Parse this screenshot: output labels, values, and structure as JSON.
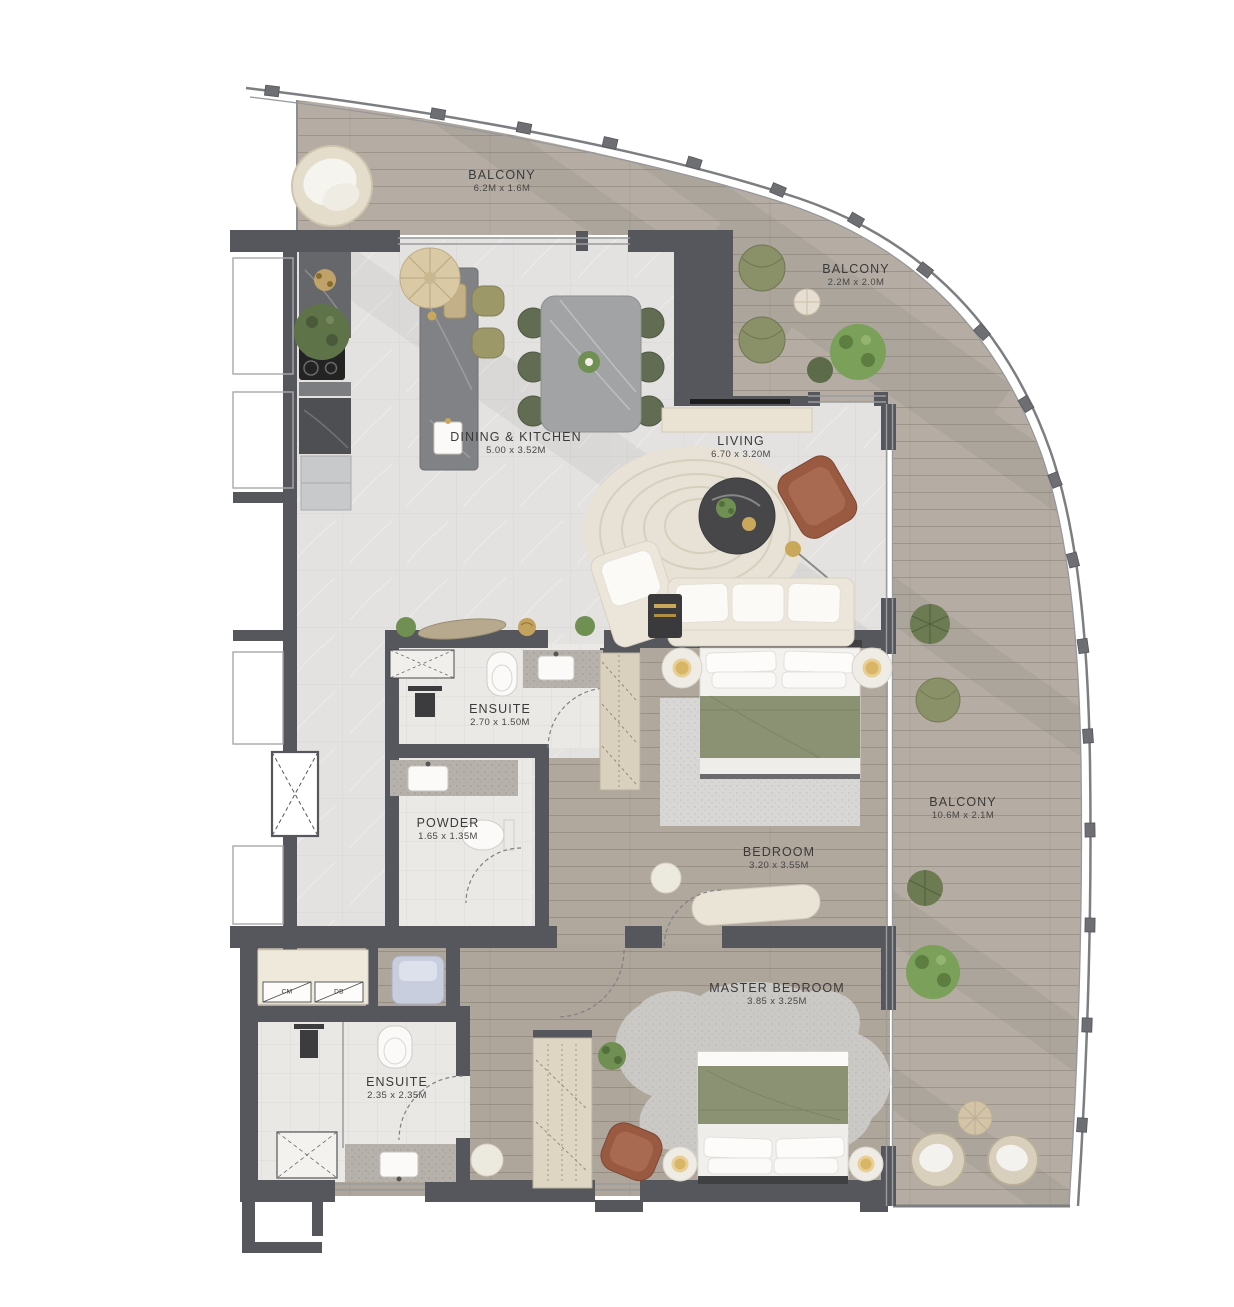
{
  "plan": {
    "rooms": [
      {
        "id": "balcony-top",
        "name": "BALCONY",
        "dims": "6.2M x 1.6M"
      },
      {
        "id": "balcony-upper-right",
        "name": "BALCONY",
        "dims": "2.2M x 2.0M"
      },
      {
        "id": "dining-kitchen",
        "name": "DINING & KITCHEN",
        "dims": "5.00 x 3.52M"
      },
      {
        "id": "living",
        "name": "LIVING",
        "dims": "6.70 x 3.20M"
      },
      {
        "id": "ensuite",
        "name": "ENSUITE",
        "dims": "2.70 x 1.50M"
      },
      {
        "id": "powder",
        "name": "POWDER",
        "dims": "1.65 x 1.35M"
      },
      {
        "id": "bedroom",
        "name": "BEDROOM",
        "dims": "3.20 x 3.55M"
      },
      {
        "id": "balcony-side",
        "name": "BALCONY",
        "dims": "10.6M x 2.1M"
      },
      {
        "id": "master-bedroom",
        "name": "MASTER BEDROOM",
        "dims": "3.85 x 3.25M"
      },
      {
        "id": "master-ensuite",
        "name": "ENSUITE",
        "dims": "2.35 x 2.35M"
      }
    ],
    "closet_labels": [
      "CM",
      "DB"
    ],
    "palette": {
      "wall": "#55575c",
      "balcony_wood": "#b5ada3",
      "interior_wood": "#b0a79d",
      "marble": "#e3e2e0",
      "bath_tile": "#ebe9e5",
      "olive": "#8b9273",
      "leather": "#9a5a42",
      "cream": "#ece6da",
      "greenery": "#7aa05a",
      "gold": "#c9a85c"
    }
  }
}
